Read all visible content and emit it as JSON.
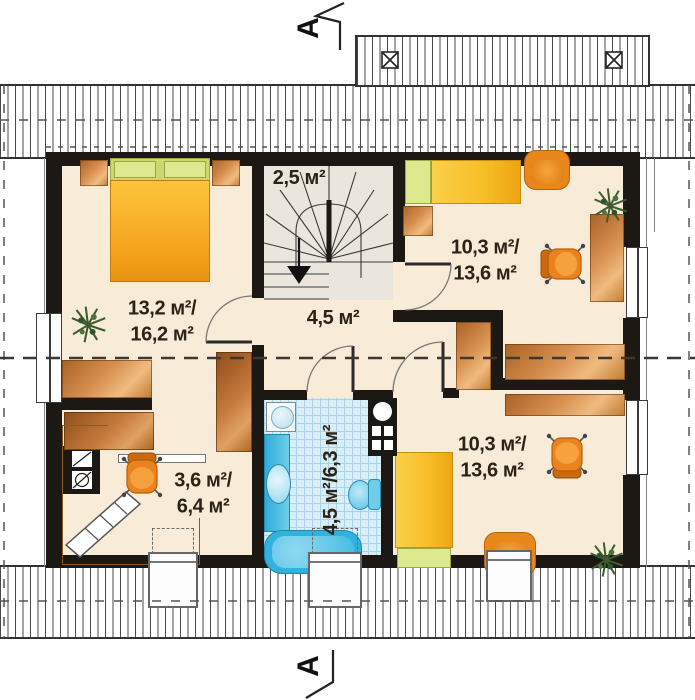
{
  "section": {
    "top_label": "A",
    "bottom_label": "A"
  },
  "rooms": {
    "bedroom": {
      "line1": "13,2 м²/",
      "line2": "16,2 м²"
    },
    "staircase": {
      "area": "2,5 м²"
    },
    "hall": {
      "area": "4,5 м²"
    },
    "room_top_right": {
      "line1": "10,3 м²/",
      "line2": "13,6 м²"
    },
    "room_bottom_right": {
      "line1": "10,3 м²/",
      "line2": "13,6 м²"
    },
    "office": {
      "line1": "3,6 м²/",
      "line2": "6,4 м²"
    },
    "bathroom": {
      "area": "4,5 м²/6,3 м²"
    }
  },
  "icons": {
    "roof_window": "⊠",
    "stair_down_arrow": "▼",
    "section_cut": "zigzag-line",
    "plant": "green-starburst"
  },
  "colors": {
    "wall": "#1c1813",
    "floor": "#f8ecd8",
    "stair_floor": "#eae6de",
    "tile_floor": "#d9eef8",
    "wood": "#d89050",
    "furniture_orange": "#e9861c",
    "bed_yellow": "#f6bb24",
    "pillow_green": "#dce98f",
    "fixture_blue": "#3cb4df",
    "hatch_line": "#4a4a4a",
    "dashed_line": "#3d3833"
  }
}
